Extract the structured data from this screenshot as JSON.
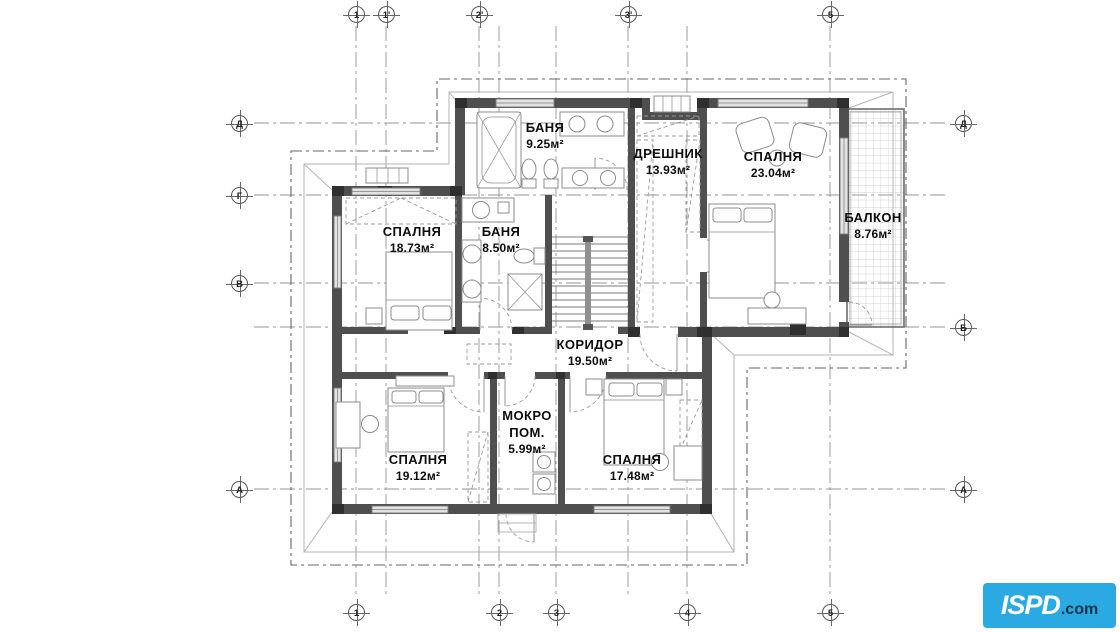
{
  "drawing": {
    "type": "residential floor plan",
    "wall_color": "#4f4f4f",
    "background": "#ffffff"
  },
  "rooms": [
    {
      "name": "БАНЯ",
      "area": "9.25м²"
    },
    {
      "name": "ДРЕШНИК",
      "area": "13.93м²"
    },
    {
      "name": "СПАЛНЯ",
      "area": "23.04м²"
    },
    {
      "name": "БАЛКОН",
      "area": "8.76м²"
    },
    {
      "name": "СПАЛНЯ",
      "area": "18.73м²"
    },
    {
      "name": "БАНЯ",
      "area": "8.50м²"
    },
    {
      "name": "КОРИДОР",
      "area": "19.50м²"
    },
    {
      "name": "СПАЛНЯ",
      "area": "19.12м²"
    },
    {
      "name": "МОКРО ПОМ.",
      "area": "5.99м²"
    },
    {
      "name": "СПАЛНЯ",
      "area": "17.48м²"
    }
  ],
  "axes": {
    "top": [
      "1",
      "1'",
      "2'",
      "3'",
      "5"
    ],
    "bottom": [
      "1",
      "2",
      "3",
      "4",
      "5"
    ],
    "left": [
      "Д",
      "Г",
      "В",
      "А"
    ],
    "right": [
      "Д",
      "Б",
      "А"
    ]
  },
  "logo": {
    "brand": "ISPD",
    "suffix": ".com",
    "bg_color": "#2BA9E2",
    "brand_color": "#FFFFFF",
    "suffix_color": "#16344D"
  }
}
